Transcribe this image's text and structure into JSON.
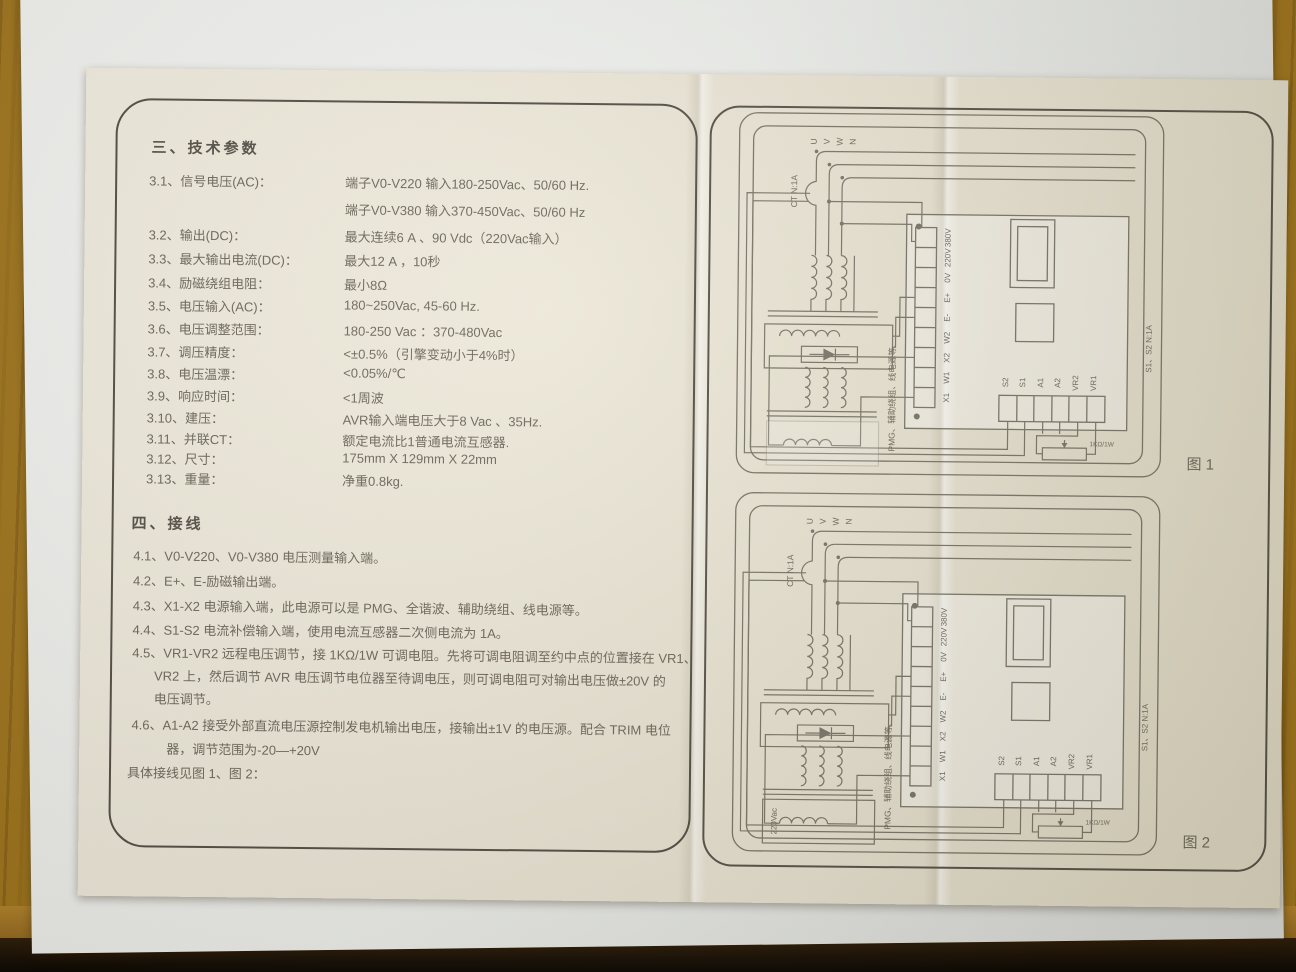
{
  "page": {
    "section3": {
      "title": "三、技术参数",
      "items": [
        {
          "label": "3.1、信号电压(AC)：",
          "value": "端子V0-V220   输入180-250Vac、50/60 Hz.",
          "value2": "端子V0-V380   输入370-450Vac、50/60 Hz"
        },
        {
          "label": "3.2、输出(DC)：",
          "value": "最大连续6 A 、90 Vdc（220Vac输入）"
        },
        {
          "label": "3.3、最大输出电流(DC)：",
          "value": "最大12 A ，10秒"
        },
        {
          "label": "3.4、励磁绕组电阻：",
          "value": "最小8Ω"
        },
        {
          "label": "3.5、电压输入(AC)：",
          "value": "180~250Vac, 45-60 Hz."
        },
        {
          "label": "3.6、电压调整范围：",
          "value": "180-250 Vac ：370-480Vac"
        },
        {
          "label": "3.7、调压精度：",
          "value": "<±0.5%（引擎变动小于4%时）"
        },
        {
          "label": "3.8、电压温漂：",
          "value": "<0.05%/℃"
        },
        {
          "label": "3.9、响应时间：",
          "value": "<1周波"
        },
        {
          "label": "3.10、建压：",
          "value": "AVR输入端电压大于8 Vac 、35Hz."
        },
        {
          "label": "3.11、并联CT：",
          "value": "额定电流比1普通电流互感器."
        },
        {
          "label": "3.12、尺寸：",
          "value": "175mm X 129mm X 22mm"
        },
        {
          "label": "3.13、重量：",
          "value": "净重0.8kg."
        }
      ]
    },
    "section4": {
      "title": "四、接线",
      "items": [
        "4.1、V0-V220、V0-V380 电压测量输入端。",
        "4.2、E+、E-励磁输出端。",
        "4.3、X1-X2 电源输入端，此电源可以是 PMG、全谐波、辅助绕组、线电源等。",
        "4.4、S1-S2 电流补偿输入端，使用电流互感器二次侧电流为 1A。",
        "4.5、VR1-VR2 远程电压调节，接 1KΩ/1W 可调电阻。先将可调电阻调至约中点的位置接在 VR1、",
        "VR2 上，然后调节 AVR 电压调节电位器至待调电压，则可调电阻可对输出电压做±20V 的",
        "电压调节。",
        "4.6、A1-A2 接受外部直流电压源控制发电机输出电压，接输出±1V 的电压源。配合 TRIM 电位",
        "器，调节范围为-20—+20V",
        "具体接线见图 1、图 2："
      ]
    }
  },
  "figures": {
    "shared": {
      "phases": [
        "U",
        "V",
        "W",
        "N"
      ],
      "ct_label": "CT N:1A",
      "terminals": [
        "380V",
        "220V",
        "0V",
        "E+",
        "E-",
        "W2",
        "X2",
        "W1",
        "X1"
      ],
      "aux_terminals": [
        "S2",
        "S1",
        "A1",
        "A2",
        "VR2",
        "VR1"
      ],
      "pot_label": "1KΩ/1W",
      "source_caption": "PMG、辅助绕组、线电源等.",
      "ct_caption": "S1、S2 N:1A"
    },
    "fig1": {
      "caption": "图 1"
    },
    "fig2": {
      "caption": "图 2",
      "source_label": "220Vac"
    }
  },
  "colors": {
    "wood": "#a0771f",
    "under_paper": "#eef0ed",
    "document_paper": "#ece7d8",
    "frame_line": "#535047",
    "print_text": "#6e695c",
    "diagram_line": "#7b776a"
  }
}
